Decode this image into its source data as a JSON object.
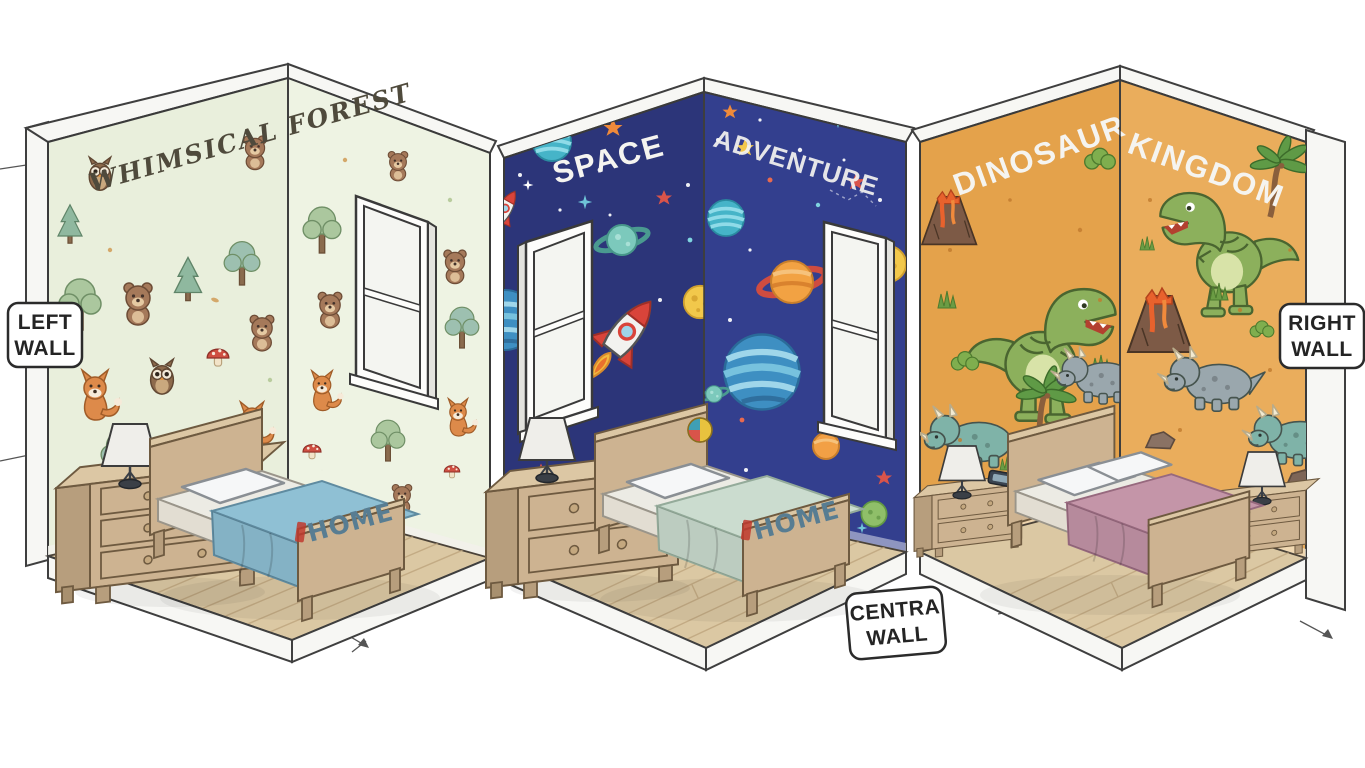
{
  "canvas": {
    "width": 1365,
    "height": 768,
    "background": "#ffffff"
  },
  "wall_labels": {
    "left": {
      "line1": "LEFT",
      "line2": "WALL"
    },
    "right": {
      "line1": "RIGHT",
      "line2": "WALL"
    },
    "central": {
      "line1": "CENTRA",
      "line2": "WALL"
    }
  },
  "rooms": [
    {
      "name": "Whimsical Forest",
      "wall_texts": [
        "WHIMSICAL FOREST",
        ""
      ],
      "footboard_text": "HOME",
      "wall_color_left": "#e9efdc",
      "wall_color_right": "#eef3e3",
      "blanket_color": "#8fc0d4"
    },
    {
      "name": "Space Adventure",
      "wall_texts": [
        "SPACE",
        "ADVENTURE"
      ],
      "footboard_text": "HOME",
      "wall_color_left": "#2c3579",
      "wall_color_right": "#333f8e",
      "blanket_color": "#cbdccf"
    },
    {
      "name": "Dinosaur Kingdom",
      "wall_texts": [
        "DINOSAUR",
        "KINGDOM"
      ],
      "footboard_text": "",
      "wall_color_left": "#e4a24b",
      "wall_color_right": "#eaad5c",
      "blanket_color": "#c495a8"
    }
  ],
  "colors": {
    "floor": "#dbc8a3",
    "board_edge": "#f7f7f4",
    "wood_front": "#cdb391",
    "wood_side": "#b79e7d",
    "wood_top": "#dcc7a4",
    "home_text": "#587d92",
    "title_forest": "#4f4a3c",
    "title_light": "#f5f4f0"
  }
}
